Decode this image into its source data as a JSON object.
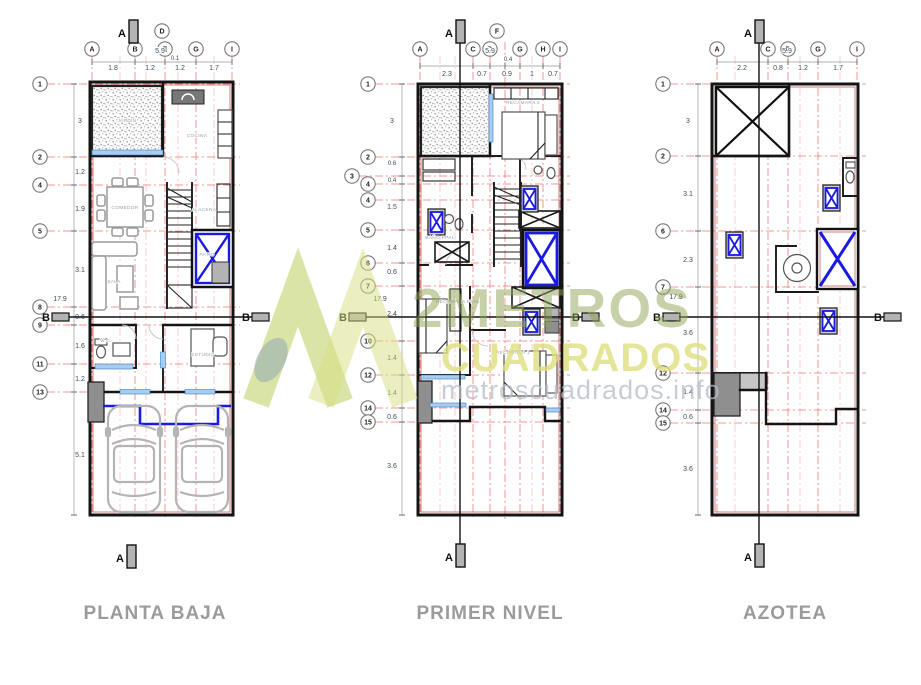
{
  "watermark": {
    "brand_top": "2METROS",
    "brand_bottom": "CUADRADOS",
    "website": "metroscuadrados.info"
  },
  "colors": {
    "grid_red": "#f07a7a",
    "wall_black": "#141414",
    "wall_accent": "#c2544a",
    "window_blue": "#1a1ae0",
    "sill_blue": "#a8cdf0",
    "brand_green": "#8fa457",
    "brand_yellow": "#dfdf7e",
    "brand_gray": "#b5bcc8",
    "title_gray": "#9b9b9b"
  },
  "plans": [
    {
      "title": "PLANTA BAJA",
      "cols": [
        "A",
        "B",
        "D",
        "E",
        "G",
        "I"
      ],
      "rows": [
        "1",
        "2",
        "4",
        "5",
        "8",
        "9",
        "11",
        "13"
      ],
      "top_dims": {
        "total": "5.9",
        "offset": "0.1",
        "segments": [
          "1.8",
          "1.2",
          "1.2",
          "1.7"
        ]
      },
      "left_dims": {
        "total": "17.9",
        "segments": [
          "3",
          "1.2",
          "1.9",
          "3.1",
          "0.6",
          "1.6",
          "1.2",
          "5.1"
        ]
      },
      "rooms": {
        "garden": "JARDIN",
        "kitchen": "COCINA",
        "dining": "COMEDOR",
        "living": "SALA",
        "pantry": "ALACENA",
        "service_patio": "PATIO",
        "wc": "W.C.",
        "study": "ESTUDIO"
      },
      "section": {
        "top": "A",
        "bottom": "A",
        "left": "B",
        "right": "B"
      }
    },
    {
      "title": "PRIMER NIVEL",
      "cols": [
        "A",
        "C",
        "D",
        "F",
        "G",
        "H",
        "I"
      ],
      "rows": [
        "1",
        "2",
        "3",
        "4",
        "4",
        "5",
        "6",
        "7",
        "10",
        "12",
        "14",
        "15"
      ],
      "top_dims": {
        "total": "5.9",
        "offset": "0.4",
        "segments": [
          "2.3",
          "0.7",
          "0.9",
          "1",
          "0.7"
        ]
      },
      "left_dims": {
        "total": "17.9",
        "segments": [
          "3",
          "0.6",
          "0.4",
          "1.5",
          "1.4",
          "0.6",
          "2.4",
          "1.4",
          "1.4",
          "0.6",
          "3.6"
        ]
      },
      "rooms": {
        "bedroom2": "RECAMARA 2",
        "main_bath": "BAÑO PPAL",
        "main_bedroom": "RECAMARA PPAL",
        "bedroom1": "RECAMARA 1"
      },
      "section": {
        "top": "A",
        "bottom": "A",
        "left": "B",
        "right": "B"
      }
    },
    {
      "title": "AZOTEA",
      "cols": [
        "A",
        "C",
        "D",
        "G",
        "I"
      ],
      "rows": [
        "1",
        "2",
        "6",
        "7",
        "12",
        "14",
        "15"
      ],
      "top_dims": {
        "total": "5.9",
        "segments": [
          "2.2",
          "0.8",
          "1.2",
          "1.7"
        ]
      },
      "left_dims": {
        "total": "17.9",
        "segments": [
          "3",
          "3.1",
          "2.3",
          "3.6",
          "1.4",
          "0.6",
          "3.6"
        ]
      },
      "rooms": {},
      "section": {
        "top": "A",
        "bottom": "A",
        "left": "B",
        "right": "B"
      }
    }
  ]
}
